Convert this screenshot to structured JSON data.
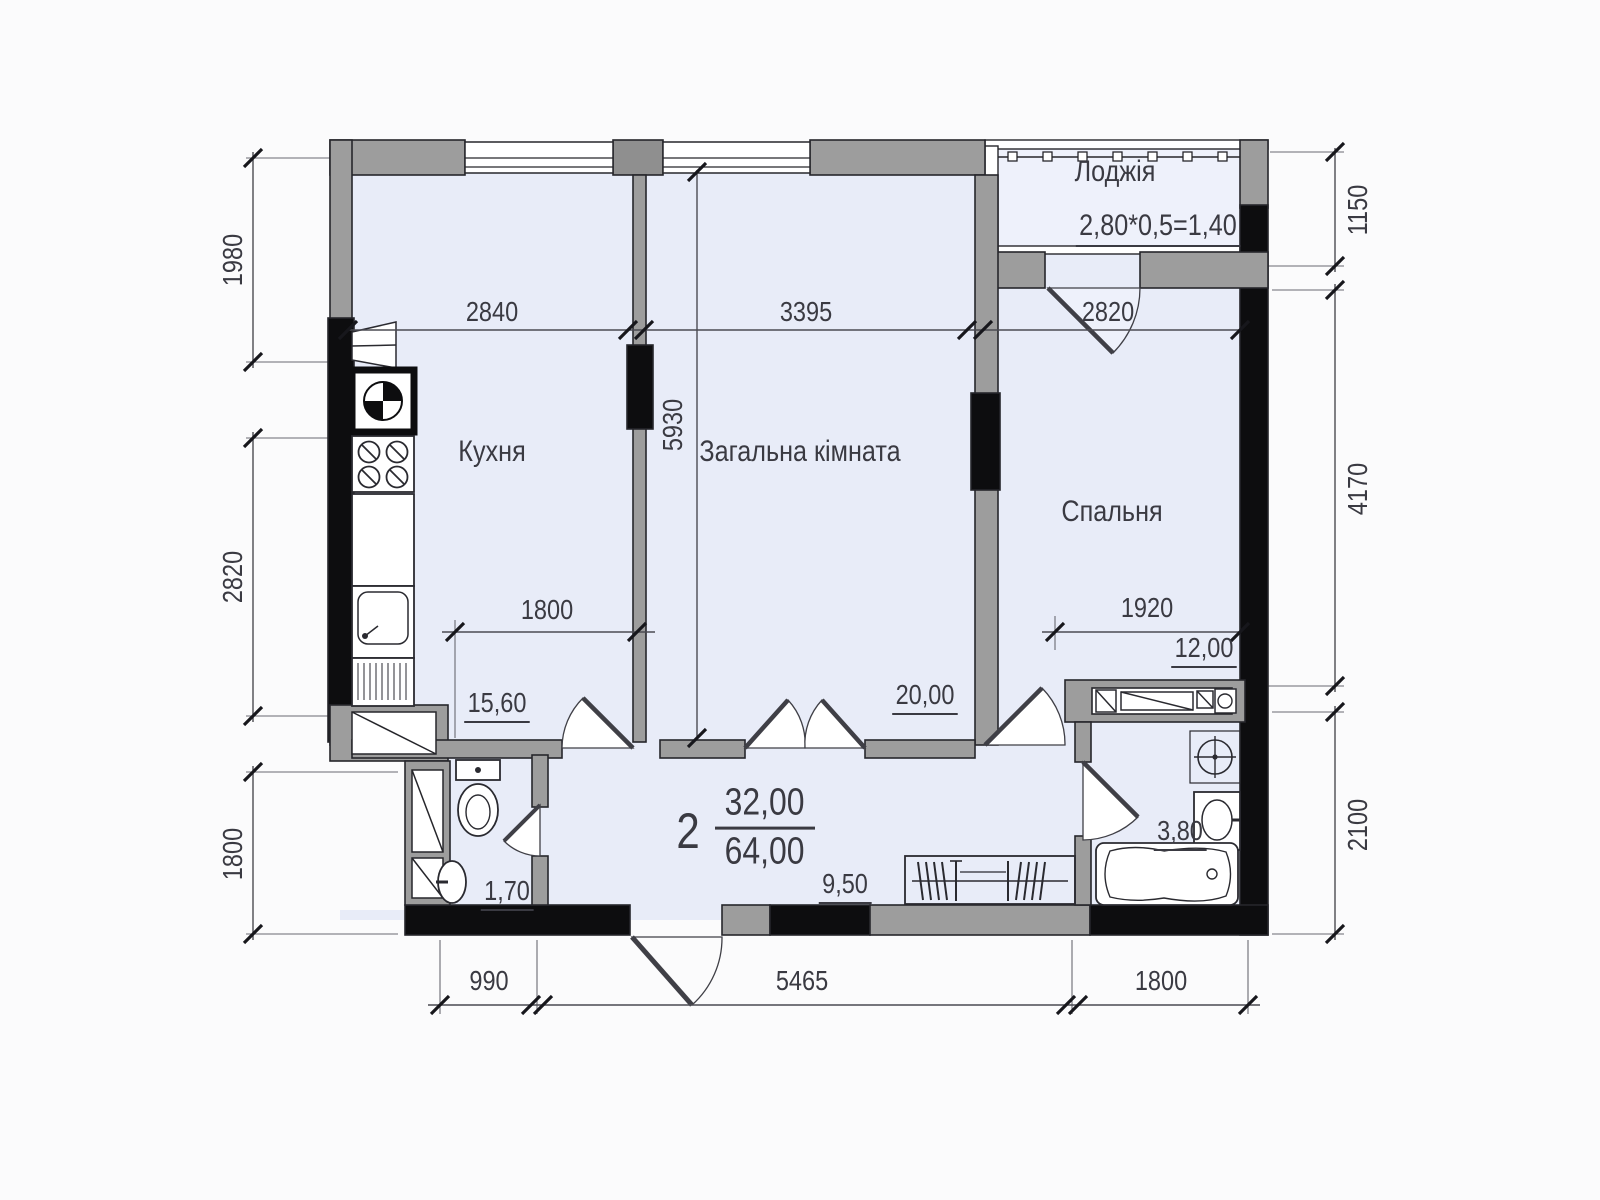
{
  "plan": {
    "summary": {
      "rooms_count": "2",
      "living_area": "32,00",
      "total_area": "64,00"
    },
    "rooms": {
      "loggia": {
        "label": "Лоджія",
        "formula": "2,80*0,5=1,40"
      },
      "kitchen": {
        "label": "Кухня",
        "area": "15,60"
      },
      "living": {
        "label": "Загальна кімната",
        "area": "20,00"
      },
      "bedroom": {
        "label": "Спальня",
        "area": "12,00"
      },
      "wc": {
        "area": "1,70"
      },
      "bathroom": {
        "area": "3,80"
      },
      "hall": {
        "area": "9,50"
      }
    },
    "dims": {
      "left_top": "1980",
      "left_mid": "2820",
      "left_bottom": "1800",
      "right_top": "1150",
      "right_mid": "4170",
      "right_bottom": "2100",
      "top_kitchen": "2840",
      "top_living": "3395",
      "top_bedroom": "2820",
      "bottom_left": "990",
      "bottom_mid": "5465",
      "bottom_right": "1800",
      "kitchen_width": "1800",
      "bedroom_width": "1920",
      "room_depth": "5930"
    },
    "colors": {
      "room_fill": "#e8ecf8",
      "wall_gray": "#9d9d9d",
      "wall_black": "#0d0d0f",
      "line": "#3a3a42"
    }
  }
}
